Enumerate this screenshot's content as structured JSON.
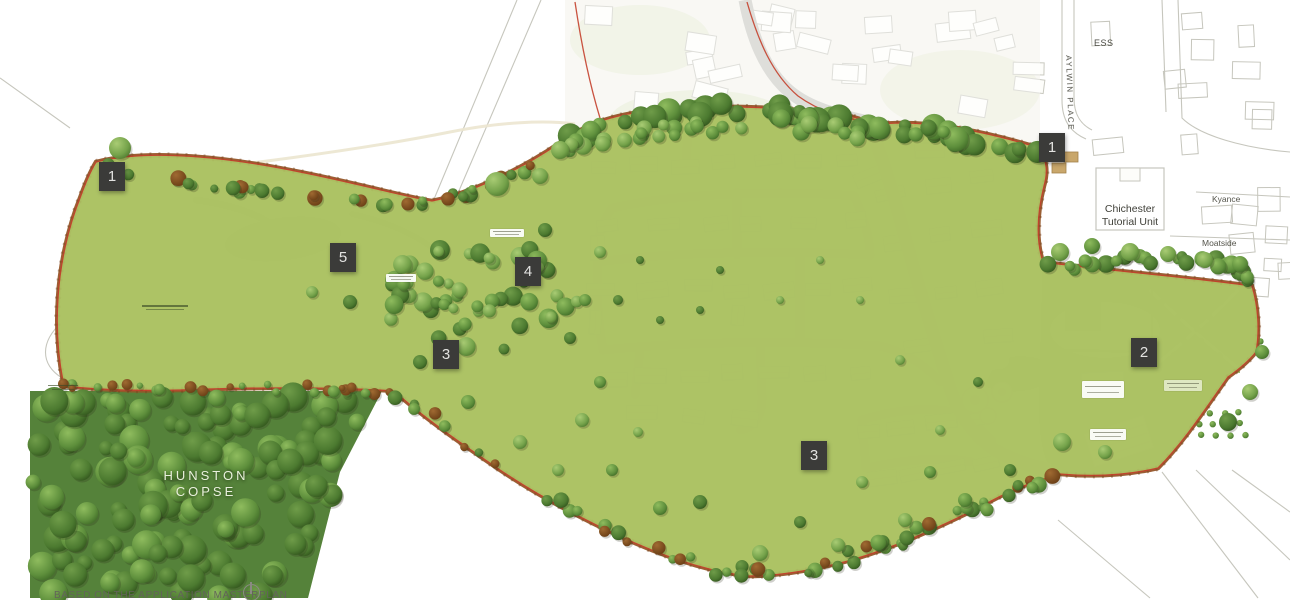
{
  "plan": {
    "title": "Illustrative site masterplan, land south of Chichester (Hunston)",
    "region_labels": {
      "ess": "ESS",
      "aylwin_place": "AYLWIN PLACE",
      "tutorial_line1": "Chichester",
      "tutorial_line2": "Tutorial Unit",
      "kyance": "Kyance",
      "moatside": "Moatside",
      "copse_line1": "HUNSTON",
      "copse_line2": "COPSE",
      "caption_partial": "BASED ON THE APPLICATION MASTERPLAN"
    },
    "markers": [
      {
        "label": "1",
        "style": "left:99px;top:162px"
      },
      {
        "label": "5",
        "style": "left:330px;top:243px"
      },
      {
        "label": "4",
        "style": "left:515px;top:257px"
      },
      {
        "label": "3",
        "style": "left:433px;top:340px"
      },
      {
        "label": "3",
        "style": "left:801px;top:441px"
      },
      {
        "label": "2",
        "style": "left:1131px;top:338px"
      },
      {
        "label": "1",
        "style": "left:1039px;top:133px"
      }
    ],
    "palette": {
      "meadow": "#adc365",
      "meadow_light": "#c3d27c",
      "site_green": "#a2bf5c",
      "housing_base": "#eae2c9",
      "plot_green": "#d9e4a8",
      "road_tan": "#d3c196",
      "road_gray": "#bcbcb6",
      "path_cream": "#ece6d0",
      "building_white": "#f8f8f4",
      "boundary_brown": "#95572a",
      "boundary_red": "#c4402c",
      "pond": "#6b8853",
      "pond_dark": "#52703f",
      "copse_base": "#55823a",
      "marker": "#3b3b39",
      "map_line": "#c6c6bd",
      "faded_base": "#f4f3ec"
    }
  }
}
